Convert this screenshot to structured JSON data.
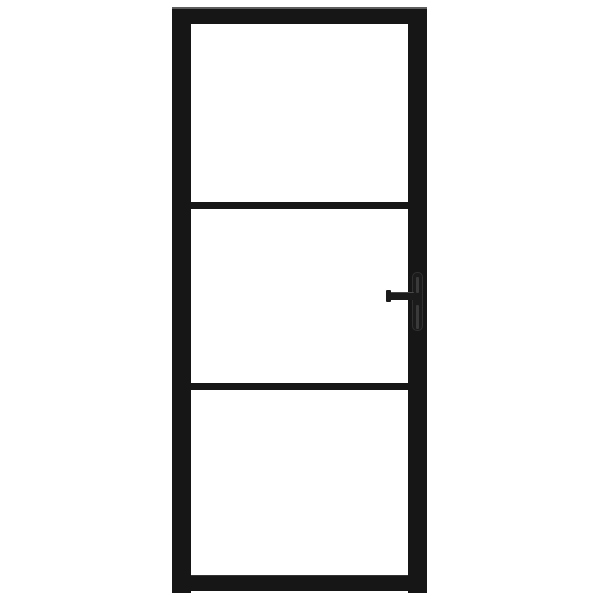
{
  "scene": {
    "object": "interior-glass-door",
    "description": "Product photo of a black steel-framed interior glass door with three clear glass panes separated by two horizontal bars, and a left-pointing black lever handle with backplate mounted on the right stile, centered on a plain white background",
    "pane_count": 3,
    "horizontal_divider_count": 2,
    "handle_side": "right",
    "handle_type": "lever-with-backplate",
    "background_style": "plain white studio backdrop, no text or watermark"
  },
  "colors": {
    "background": "#ffffff",
    "glass": "#ffffff",
    "frame": "#161616",
    "frame_highlight": "#777777",
    "handle": "#1b1b1b",
    "handle_highlight": "#4a4a4a",
    "backplate_outline": "#303030",
    "plate_slot": "#3a3a3a"
  }
}
